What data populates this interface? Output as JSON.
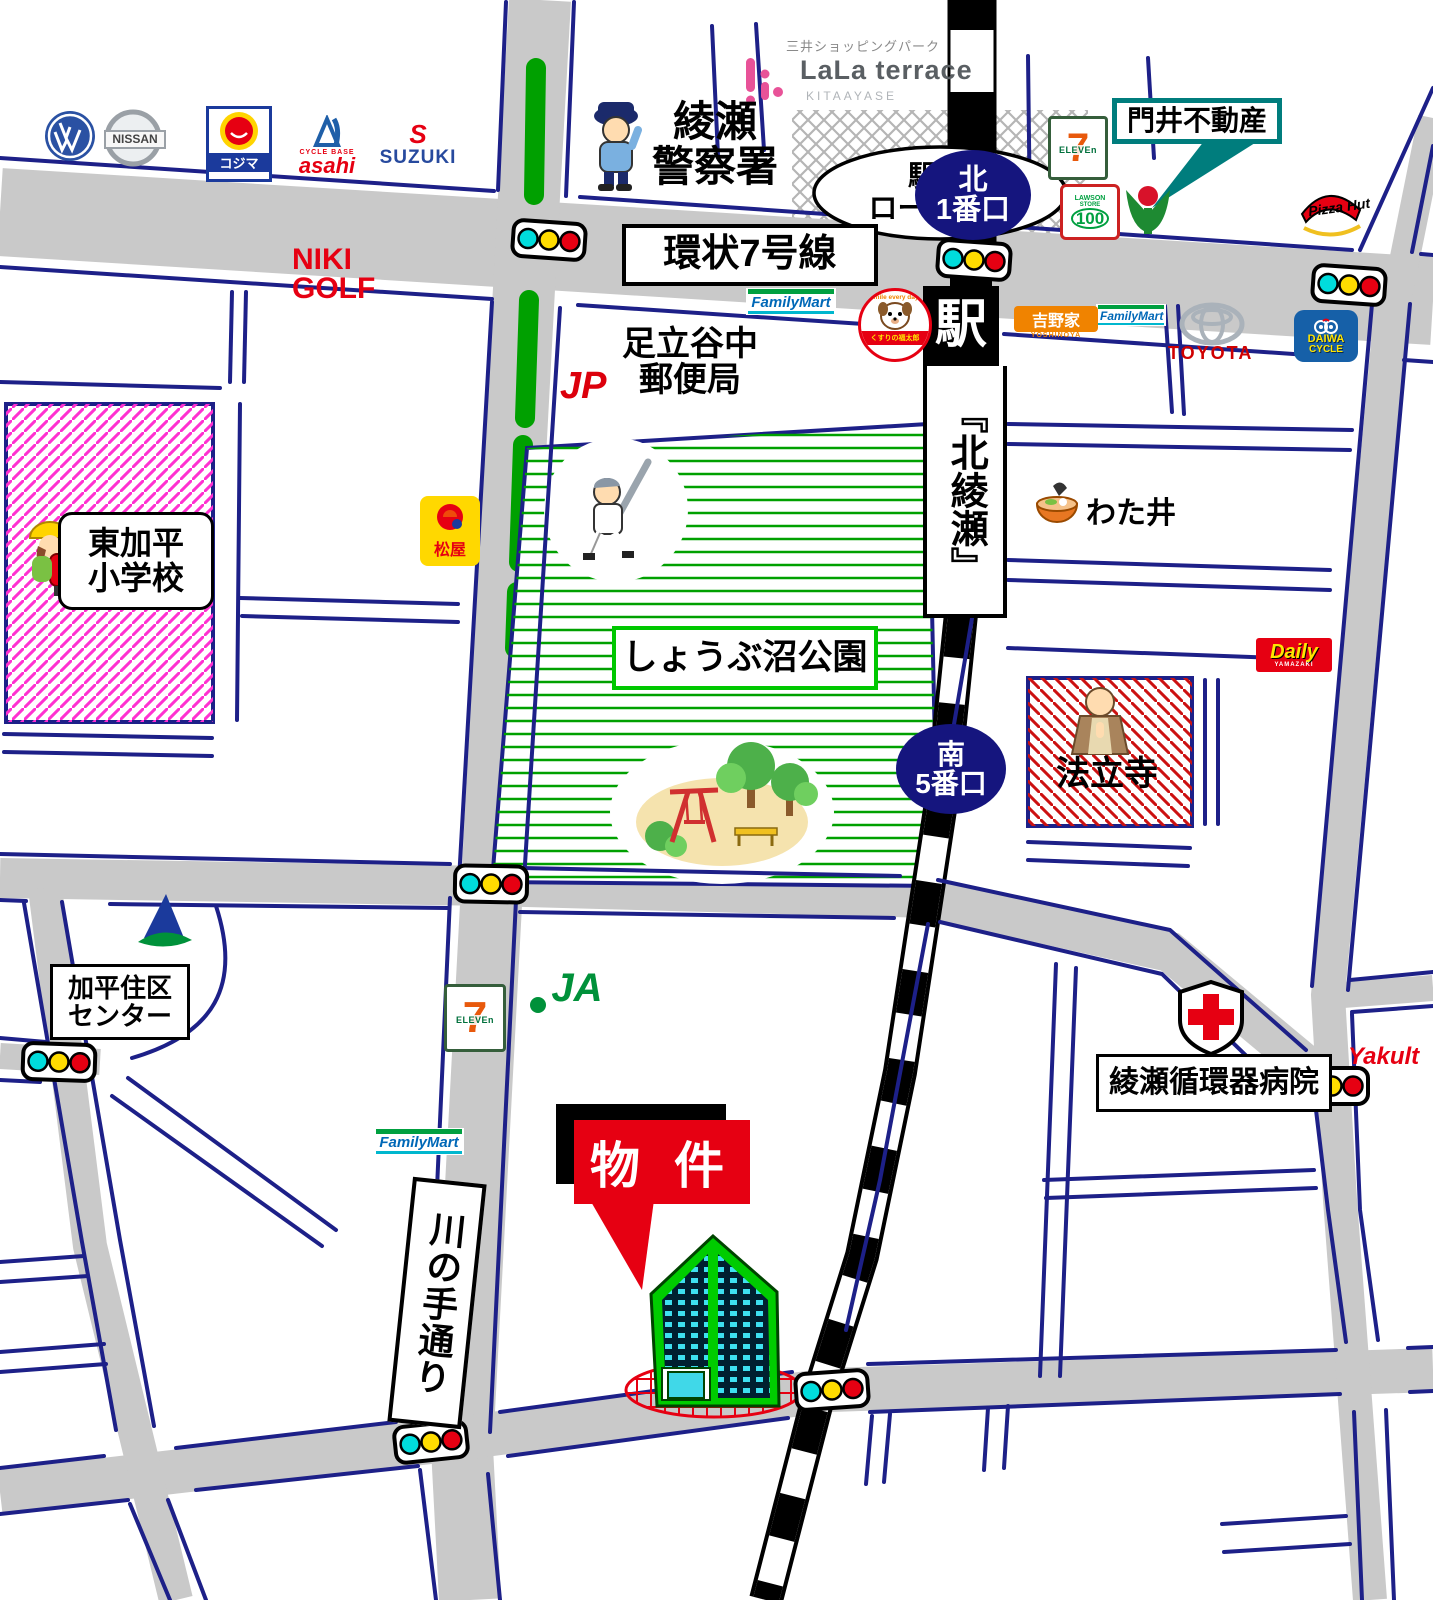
{
  "station": {
    "symbol": "駅",
    "name": "『北綾瀬』",
    "north_exit": [
      "北",
      "1番口"
    ],
    "south_exit": [
      "南",
      "5番口"
    ],
    "rotary": [
      "駅 前",
      "ロータリー"
    ]
  },
  "roads": {
    "kanjo7": "環状7号線",
    "kawanote": "川の手通り"
  },
  "property": {
    "label": "物 件"
  },
  "places": {
    "police": [
      "綾瀬",
      "警察署"
    ],
    "post_office": [
      "足立谷中",
      "郵便局"
    ],
    "school": [
      "東加平",
      "小学校"
    ],
    "park": "しょうぶ沼公園",
    "temple": "法立寺",
    "watai": "わた井",
    "community_center": [
      "加平住区",
      "センター"
    ],
    "hospital": "綾瀬循環器病院",
    "kadoi": "門井不動産",
    "niki_golf": [
      "NIKI",
      "GOLF"
    ]
  },
  "brands": {
    "lala": {
      "parent": "三井ショッピングパーク",
      "name": "LaLa terrace",
      "sub": "KITAAYASE"
    },
    "nissan": "NISSAN",
    "kojima": "コジマ",
    "asahi": {
      "top": "CYCLE BASE",
      "name": "asahi"
    },
    "suzuki": {
      "mark": "S",
      "name": "SUZUKI"
    },
    "seven": {
      "digit": "7",
      "word": "ELEVEn"
    },
    "lawson": {
      "l1": "LAWSON",
      "l2": "STORE",
      "l3": "100"
    },
    "pizza_hut": "Pizza Hut",
    "familymart": "FamilyMart",
    "kusuri": {
      "arc": "Smile every day!",
      "name": "くすりの福太郎"
    },
    "yoshinoya": {
      "name": "吉野家",
      "sub": "YOSHINOYA"
    },
    "toyota": "TOYOTA",
    "daiwa": {
      "l1": "DAIWA",
      "l2": "CYCLE"
    },
    "matsuya": "松屋",
    "daily": {
      "name": "Daily",
      "sub": "YAMAZAKI"
    },
    "ja": "JA",
    "jp": "JP",
    "yakult": "Yakult"
  },
  "colors": {
    "road_gray": "#c9c9c9",
    "block_blue": "#1d2088",
    "park_green": "#00a000",
    "navy_oval": "#15157e",
    "accent_red": "#e60012",
    "teal": "#007d7d",
    "school_pink": "#ff30d0"
  }
}
